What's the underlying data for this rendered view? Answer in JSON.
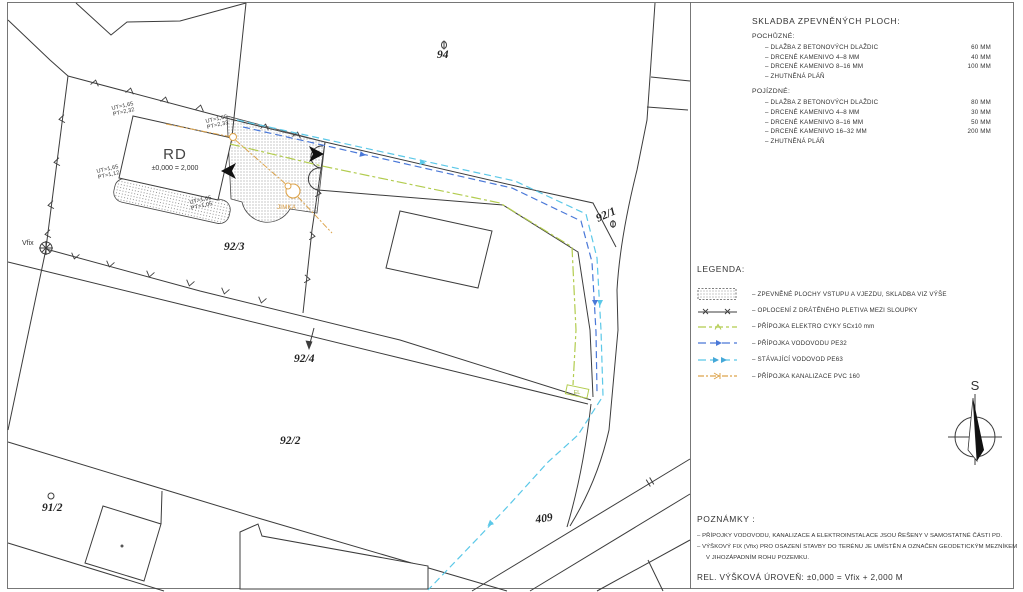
{
  "plan": {
    "parcel_labels": {
      "p94": "94",
      "p92_1": "92/1",
      "p92_2": "92/2",
      "p92_3": "92/3",
      "p92_4": "92/4",
      "p91_2": "91/2",
      "road_409": "409"
    },
    "house": {
      "label": "RD",
      "level_note": "±0,000 = 2,000"
    },
    "markers": {
      "vfix": "Vfix",
      "jimka": "JIMKA",
      "el": "EL"
    },
    "elevations": {
      "nw": [
        "UT=1,65",
        "PT=2,32"
      ],
      "ne": [
        "UT=1,65",
        "PT=2,33"
      ],
      "w": [
        "UT=1,65",
        "PT=1,12"
      ],
      "s": [
        "UT=1,65",
        "PT=1,05"
      ]
    }
  },
  "panel": {
    "skladba": {
      "title": "SKLADBA ZPEVNĚNÝCH PLOCH:",
      "sections": [
        {
          "heading": "POCHŮZNÉ:",
          "rows": [
            {
              "label": "–  DLAŽBA Z BETONOVÝCH DLAŽDIC",
              "value": "60 MM"
            },
            {
              "label": "–  DRCENÉ KAMENIVO 4–8 MM",
              "value": "40 MM"
            },
            {
              "label": "–  DRCENÉ KAMENIVO 8–16 MM",
              "value": "100 MM"
            },
            {
              "label": "–  ZHUTNĚNÁ PLÁŇ",
              "value": ""
            }
          ]
        },
        {
          "heading": "POJÍZDNÉ:",
          "rows": [
            {
              "label": "–  DLAŽBA Z BETONOVÝCH DLAŽDIC",
              "value": "80 MM"
            },
            {
              "label": "–  DRCENÉ KAMENIVO 4–8 MM",
              "value": "30 MM"
            },
            {
              "label": "–  DRCENÉ KAMENIVO 8–16 MM",
              "value": "50 MM"
            },
            {
              "label": "–  DRCENÉ KAMENIVO 16–32 MM",
              "value": "200 MM"
            },
            {
              "label": "–  ZHUTNĚNÁ PLÁŇ",
              "value": ""
            }
          ]
        }
      ]
    },
    "legend": {
      "title": "LEGENDA:",
      "items": [
        {
          "symbol": "paved-hatch-swatch",
          "label": "–  ZPEVNĚNÉ PLOCHY VSTUPU A VJEZDU, SKLADBA VIZ VÝŠE"
        },
        {
          "symbol": "fence-symbol",
          "label": "–  OPLOCENÍ Z DRÁTĚNÉHO PLETIVA MEZI SLOUPKY"
        },
        {
          "symbol": "electro-line-symbol",
          "label": "–  PŘÍPOJKA ELEKTRO CYKY 5Cx10 mm"
        },
        {
          "symbol": "water-new-line-symbol",
          "label": "–  PŘÍPOJKA VODOVODU PE32"
        },
        {
          "symbol": "water-exist-line-symbol",
          "label": "–  STÁVAJÍCÍ VODOVOD PE63"
        },
        {
          "symbol": "sewer-line-symbol",
          "label": "–  PŘÍPOJKA KANALIZACE PVC 160"
        }
      ]
    },
    "north_label": "S",
    "notes": {
      "title": "POZNÁMKY :",
      "lines": [
        "–  PŘÍPOJKY VODOVODU, KANALIZACE A ELEKTROINSTALACE JSOU ŘEŠENY V SAMOSTATNÉ ČÁSTI PD.",
        "–  VÝŠKOVÝ FIX (Vfix) PRO OSAZENÍ STAVBY DO TERÉNU JE UMÍSTĚN A OZNAČEN GEODETICKÝM MEZNÍKEM",
        "V JIHOZÁPADNÍM ROHU POZEMKU."
      ]
    },
    "rel_line": "REL. VÝŠKOVÁ ÚROVEŇ: ±0,000  =  Vfix + 2,000 M"
  },
  "colors": {
    "line": "#3c3c3c",
    "hatch_dot": "#606060",
    "water_new": "#4a78d8",
    "water_existing": "#5bc8e8",
    "electro": "#b2cc4e",
    "sewer": "#dda44c"
  }
}
